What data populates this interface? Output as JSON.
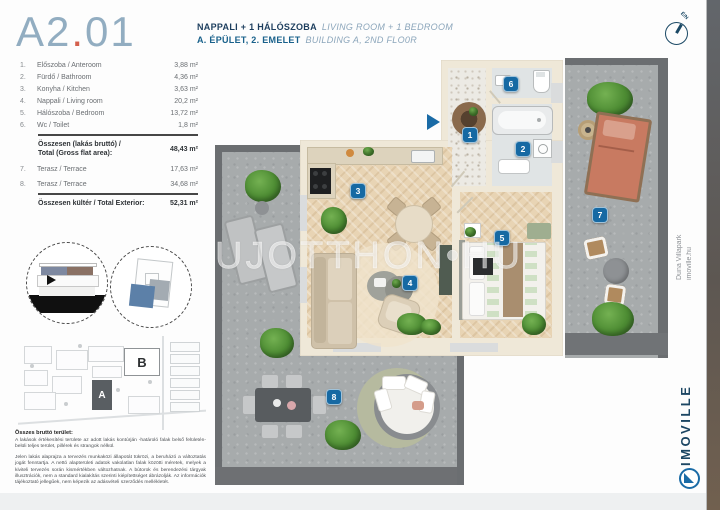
{
  "page": {
    "unit_title": {
      "part1": "A2",
      "dot": ".",
      "part2": "01"
    },
    "header": {
      "line1_hu": "NAPPALI + 1 HÁLÓSZOBA",
      "line1_en": "LIVING ROOM + 1 BEDROOM",
      "line2_hu": "A. ÉPÜLET, 2. EMELET",
      "line2_en": "BUILDING A, 2ND FLO0R"
    },
    "compass_label": "É/N"
  },
  "area_table": {
    "rows": [
      {
        "num": "1.",
        "name": "Előszoba / Anteroom",
        "value": "3,88 m²"
      },
      {
        "num": "2.",
        "name": "Fürdő / Bathroom",
        "value": "4,36 m²"
      },
      {
        "num": "3.",
        "name": "Konyha / Kitchen",
        "value": "3,63 m²"
      },
      {
        "num": "4.",
        "name": "Nappali / Living room",
        "value": "20,2 m²"
      },
      {
        "num": "5.",
        "name": "Hálószoba / Bedroom",
        "value": "13,72 m²"
      },
      {
        "num": "6.",
        "name": "Wc / Toilet",
        "value": "1,8 m²"
      }
    ],
    "total_flat": {
      "label_line1": "Összesen (lakás bruttó) /",
      "label_line2": "Total (Gross flat area):",
      "value": "48,43 m²"
    },
    "terrace_rows": [
      {
        "num": "7.",
        "name": "Terasz / Terrace",
        "value": "17,63 m²"
      },
      {
        "num": "8.",
        "name": "Terasz / Terrace",
        "value": "34,68 m²"
      }
    ],
    "total_exterior": {
      "label": "Összesen kültér / Total Exterior:",
      "value": "52,31 m²"
    }
  },
  "site_plan": {
    "building_a_label": "A",
    "building_b_label": "B"
  },
  "legal": {
    "heading": "Összes bruttó terület:",
    "para1": "A lakások értékesítési területe az adott lakás kontúrján -határoló falak belső felületén- belüli teljes terület, pillérek és strangok nélkül.",
    "para2": "Jelen lakás alaprajza a tervezés munkaközi állapotát tükrözi, a beruházó a változtatás jogát fenntartja. A nettó alapterületi adatok vakolatlan falak közötti méretek, melyek a kiviteli tervezés során kismértékben változhatnak. A bútorok és berendezési tárgyak illusztrációk, nem a standard kialakítás szerinti kiépítettséget ábrázolják. Az információk tájékoztató jellegűek, nem képezik az adásvételi szerződés mellékletét."
  },
  "floor_plan": {
    "watermark": "UJOTTHON•HU",
    "badges": [
      "1",
      "2",
      "3",
      "4",
      "5",
      "6",
      "7",
      "8"
    ]
  },
  "sidebar": {
    "project_line1": "Duna Villapark",
    "project_line2": "imoville.hu",
    "brand": "IMOVILLE"
  },
  "colors": {
    "accent_blue": "#1a6ba6",
    "navy": "#1d3e5e",
    "title_blue": "#92adc1",
    "title_dot": "#d4604d"
  }
}
